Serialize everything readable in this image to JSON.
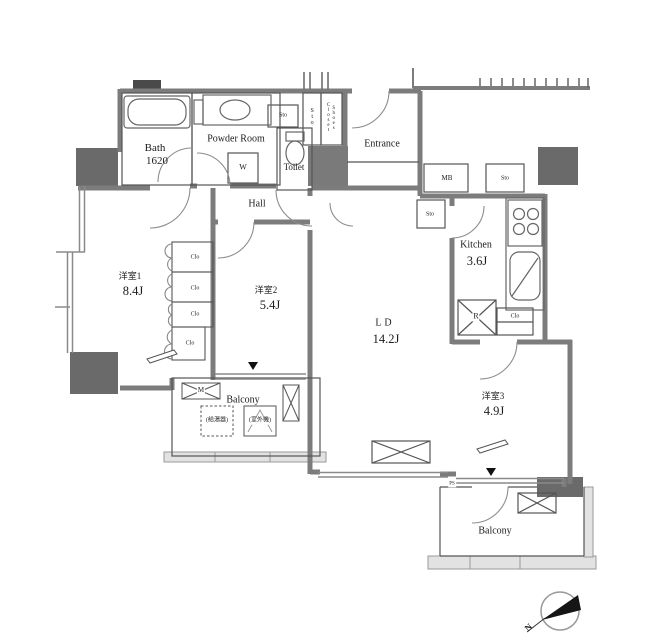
{
  "rooms": [
    {
      "name": "Bath",
      "size": "1620"
    },
    {
      "name": "Powder Room",
      "size": ""
    },
    {
      "name": "Toilet",
      "size": ""
    },
    {
      "name": "Hall",
      "size": ""
    },
    {
      "name": "Entrance",
      "size": ""
    },
    {
      "name": "Kitchen",
      "size": "3.6J"
    },
    {
      "name": "LD",
      "size": "14.2J"
    },
    {
      "name": "洋室1",
      "size": "8.4J"
    },
    {
      "name": "洋室2",
      "size": "5.4J"
    },
    {
      "name": "洋室3",
      "size": "4.9J"
    },
    {
      "name": "Balcony",
      "size": ""
    },
    {
      "name": "Balcony",
      "size": ""
    }
  ],
  "labels": {
    "washing_machine": "W",
    "storage": "Sto",
    "shoes_closet": "Shoes\nCloset",
    "meter_box": "MB",
    "closet": "Clo",
    "refrigerator": "R",
    "water_heater": "(給湯器)",
    "ac_outdoor_unit": "(室外機)",
    "meter": "M",
    "pipe_space": "PS"
  },
  "compass": {
    "north_label": "N"
  }
}
